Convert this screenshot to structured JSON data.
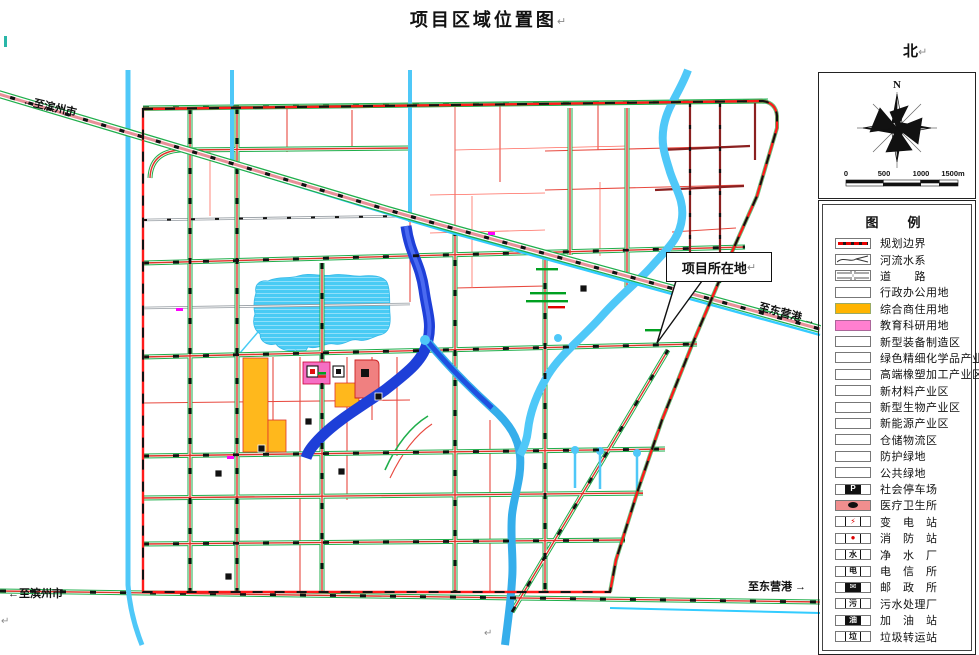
{
  "title": {
    "text": "项目区域位置图",
    "pilcrow": "↵"
  },
  "north": {
    "text": "北",
    "pilcrow": "↵"
  },
  "compass": {
    "n_label": "N"
  },
  "scale_bar": {
    "ticks": [
      "0",
      "500",
      "1000",
      "1500m"
    ]
  },
  "map": {
    "callout": {
      "text": "项目所在地",
      "pilcrow": "↵"
    },
    "road_labels": [
      {
        "id": "to-binzhou-top",
        "display": "←至滨州市"
      },
      {
        "id": "to-binzhou-bottom",
        "display": "←至滨州市"
      },
      {
        "id": "to-dongying-mid",
        "display": "至东营港 →"
      },
      {
        "id": "to-dongying-bottom",
        "display": "至东营港 →"
      }
    ],
    "stray_marks": {
      "pilcrow_bottom_left": "↵",
      "pilcrow_bottom_center": "↵"
    }
  },
  "legend": {
    "header": "图　例",
    "items": [
      {
        "label": "规划边界",
        "swatch": "boundary"
      },
      {
        "label": "河流水系",
        "swatch": "river"
      },
      {
        "label": "道　　路",
        "swatch": "road"
      },
      {
        "label": "行政办公用地",
        "swatch": "plain"
      },
      {
        "label": "综合商住用地",
        "swatch": "fill",
        "color": "#FFB400"
      },
      {
        "label": "教育科研用地",
        "swatch": "fill",
        "color": "#FF7FD0"
      },
      {
        "label": "新型装备制造区",
        "swatch": "plain"
      },
      {
        "label": "绿色精细化学品产业区",
        "swatch": "plain"
      },
      {
        "label": "高端橡塑加工产业区",
        "swatch": "plain"
      },
      {
        "label": "新材料产业区",
        "swatch": "plain"
      },
      {
        "label": "新型生物产业区",
        "swatch": "plain"
      },
      {
        "label": "新能源产业区",
        "swatch": "plain"
      },
      {
        "label": "仓储物流区",
        "swatch": "plain"
      },
      {
        "label": "防护绿地",
        "swatch": "plain"
      },
      {
        "label": "公共绿地",
        "swatch": "plain"
      },
      {
        "label": "社会停车场",
        "swatch": "icon",
        "icon": "P"
      },
      {
        "label": "医疗卫生所",
        "swatch": "icon",
        "icon": "●",
        "color": "#F08E8E"
      },
      {
        "label": "变　电　站",
        "swatch": "icon",
        "icon": "⚡"
      },
      {
        "label": "消　防　站",
        "swatch": "icon",
        "icon": "●"
      },
      {
        "label": "净　水　厂",
        "swatch": "icon",
        "icon": "水"
      },
      {
        "label": "电　信　所",
        "swatch": "icon",
        "icon": "电"
      },
      {
        "label": "邮　政　所",
        "swatch": "icon",
        "icon": "✉"
      },
      {
        "label": "污水处理厂",
        "swatch": "icon",
        "icon": "污"
      },
      {
        "label": "加　油　站",
        "swatch": "icon",
        "icon": "油"
      },
      {
        "label": "垃圾转运站",
        "swatch": "icon",
        "icon": "垃"
      }
    ]
  },
  "colors": {
    "road_red": "#E0342B",
    "road_green": "#1FAE4B",
    "canal_cyan": "#4FC8F8",
    "river_dark_blue": "#1E3FD8",
    "lake_blue": "#49CBF4",
    "railway_pink": "#E89098",
    "boundary_red": "#FF1A1A",
    "parcel_orange": "#FFB81C",
    "parcel_pink": "#F56FC4",
    "parcel_medical": "#F08080",
    "magenta_mark": "#FF00FF"
  }
}
